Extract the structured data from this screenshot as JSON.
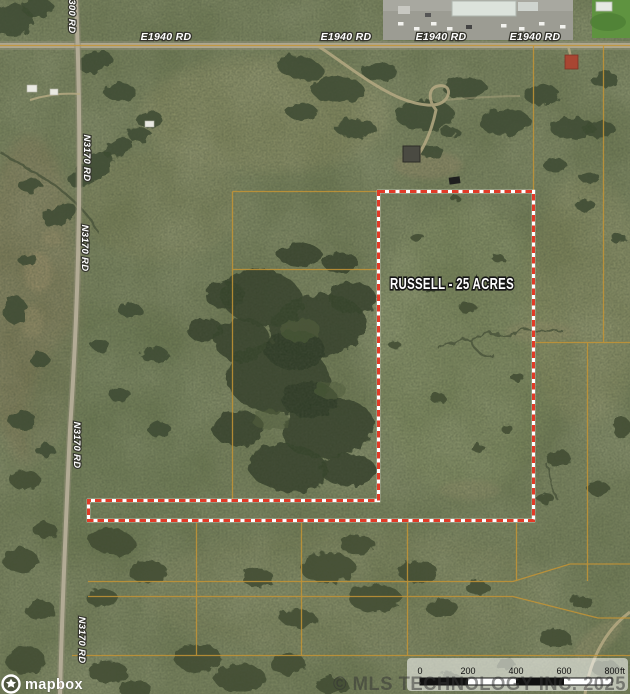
{
  "map_type": "satellite-aerial",
  "parcel": {
    "label": "RUSSELL - 25 ACRES",
    "boundary_color": "#e23b28"
  },
  "roads": {
    "e1940_label": "E1940 RD",
    "n3170_label": "N3170 RD",
    "n3300_label": "N3300 RD"
  },
  "scale_bar": {
    "ticks": [
      "0",
      "200",
      "400",
      "600",
      "800"
    ],
    "unit": "ft"
  },
  "attribution": {
    "logo": "mapbox",
    "watermark": "© MLS TECHNOLOGY INC. 2025"
  },
  "colors": {
    "terrain_base": "#727d57",
    "tree_cover": "#3c4930",
    "road_surface": "#b2ab95",
    "cadastral_line": "#c49435",
    "boundary_red": "#e23b28",
    "label_text": "#ffffff"
  }
}
